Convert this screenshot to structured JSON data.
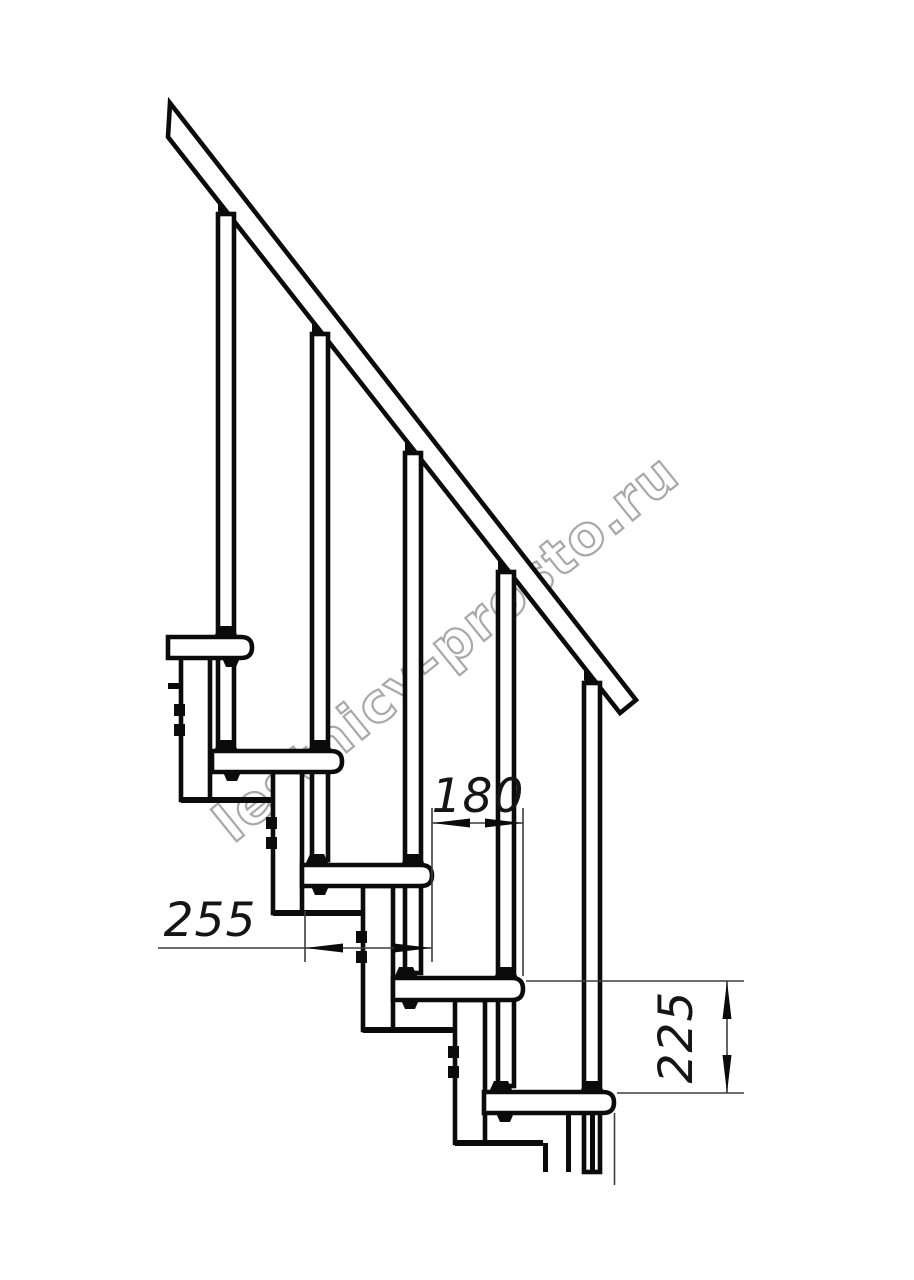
{
  "drawing": {
    "kind": "modular staircase side elevation drawing",
    "watermark": {
      "text": "lestnicy-prosto.ru",
      "color": "#a8a8a8"
    },
    "line_color": "#0b0b0b",
    "background_color": "#ffffff",
    "dimensions": {
      "step_run": {
        "value": "180",
        "orientation": "horizontal"
      },
      "tread_depth": {
        "value": "255",
        "orientation": "horizontal"
      },
      "step_rise": {
        "value": "225",
        "orientation": "vertical"
      }
    }
  }
}
